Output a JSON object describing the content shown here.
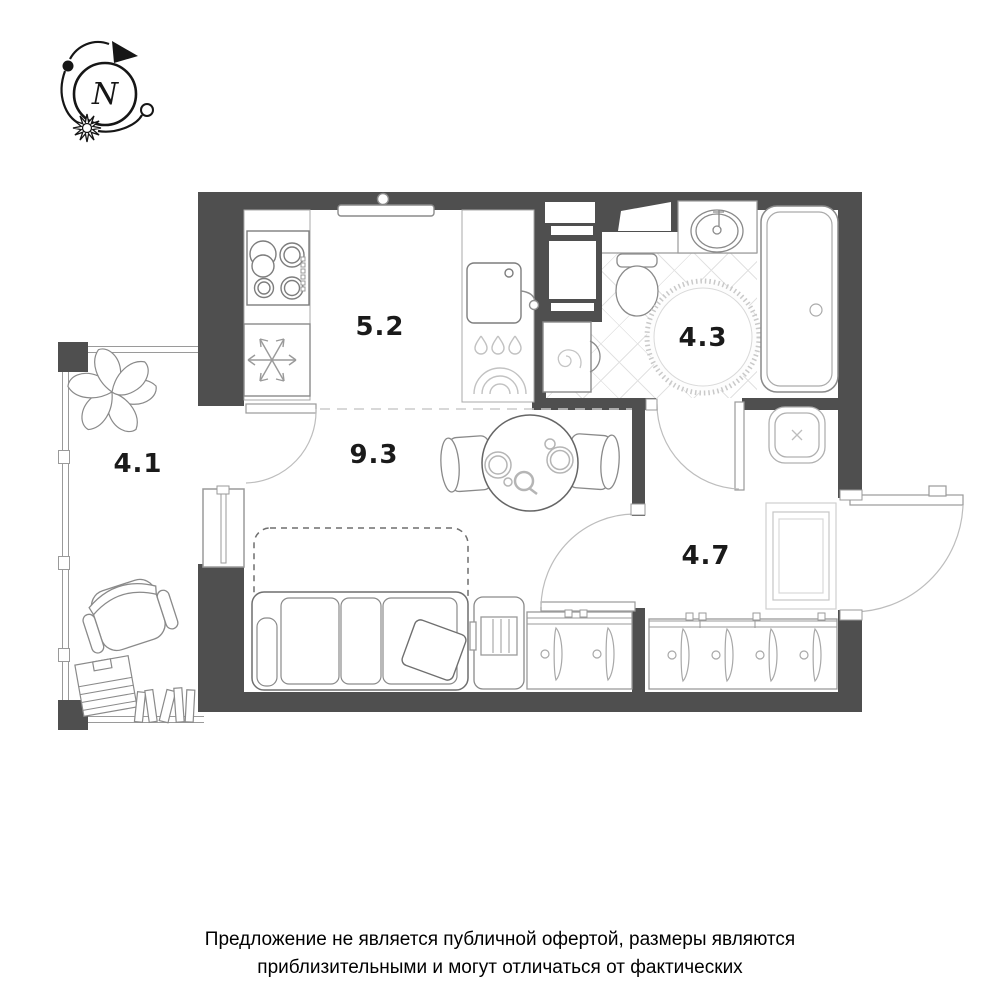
{
  "colors": {
    "wall": "#4f4f4f",
    "line": "#8a8a8a",
    "line_light": "#c6c6c6",
    "tile": "#e2e2e2",
    "label": "#1a1a1a"
  },
  "compass": {
    "north_label": "N"
  },
  "rooms": [
    {
      "name": "kitchen",
      "area_label": "5.2"
    },
    {
      "name": "living-room",
      "area_label": "9.3"
    },
    {
      "name": "bathroom",
      "area_label": "4.3"
    },
    {
      "name": "hallway",
      "area_label": "4.7"
    },
    {
      "name": "balcony",
      "area_label": "4.1"
    }
  ],
  "disclaimer": {
    "line1": "Предложение не является публичной офертой, размеры являются",
    "line2": "приблизительными и могут отличаться от фактических"
  }
}
